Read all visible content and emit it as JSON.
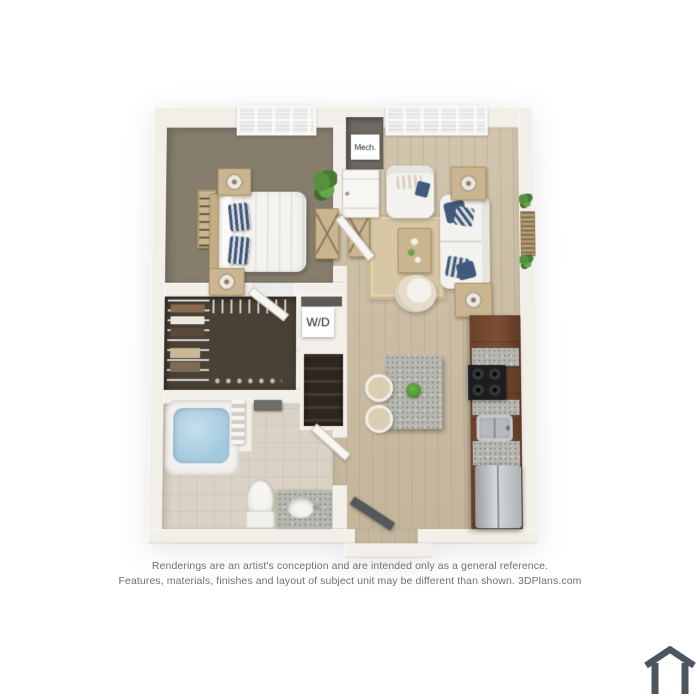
{
  "labels": {
    "mech": "Mech.",
    "wd": "W/D"
  },
  "disclaimer": {
    "line1": "Renderings are an artist's conception and are intended only as a general reference.",
    "line2": "Features, materials, finishes and layout of subject unit may be different than shown. 3DPlans.com"
  },
  "branding": {
    "icon": "house-outline"
  },
  "palette": {
    "bg": "#ffffff",
    "wall": "#f2efe9",
    "wood": "#cdbfa5",
    "carpet": "#867d6d",
    "closet": "#4a4136",
    "tile": "#dad3c5",
    "rug": "#d8c7a5",
    "cabinet": "#73482f",
    "granite": "#b6b7b0",
    "navy": "#41597c",
    "water": "#a3c9de",
    "tan": "#cbb590",
    "white-furn": "#f3f2ef",
    "steel": "#b7babc",
    "range": "#1d1d1f",
    "plant": "#55913e",
    "text": "#6e7074",
    "label": "#1c1c1c",
    "slate": "#4d565e"
  }
}
